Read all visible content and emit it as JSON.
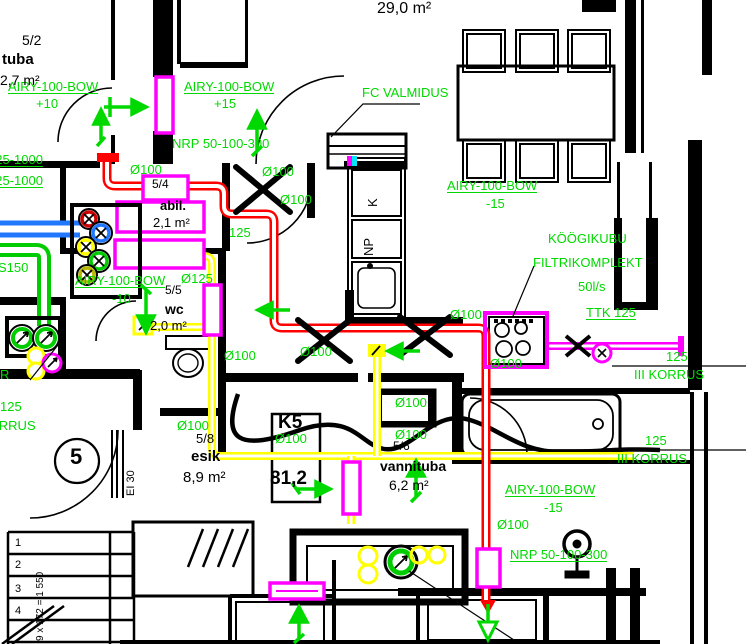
{
  "meta": {
    "drawing_type": "ventilation floor plan",
    "floor_reference": "III KORRUS",
    "apartment_code": "K5",
    "apartment_area": "81,2"
  },
  "colors": {
    "duct_exhaust_red": "#ff0000",
    "duct_yellow": "#ffff00",
    "silencer_magenta": "#ff00ff",
    "duct_supply_green": "#00cc00",
    "duct_blue": "#2277ff",
    "annotation_green": "#00d900",
    "line_black": "#000000",
    "background": "#ffffff"
  },
  "annotations": [
    {
      "t": "AIRY-100-BOW",
      "x": 8,
      "y": 80,
      "c": "g",
      "u": 1
    },
    {
      "t": "+10",
      "x": 36,
      "y": 97,
      "c": "g"
    },
    {
      "t": "AIRY-100-BOW",
      "x": 184,
      "y": 80,
      "c": "g",
      "u": 1
    },
    {
      "t": "+15",
      "x": 214,
      "y": 97,
      "c": "g"
    },
    {
      "t": "FC VALMIDUS",
      "x": 362,
      "y": 86,
      "c": "g"
    },
    {
      "t": "NRP 50-100-300",
      "x": 172,
      "y": 137,
      "c": "g"
    },
    {
      "t": "AIRY-100-BOW",
      "x": 447,
      "y": 179,
      "c": "g",
      "u": 1
    },
    {
      "t": "-15",
      "x": 486,
      "y": 197,
      "c": "g"
    },
    {
      "t": "KÖÖGIKUBU",
      "x": 548,
      "y": 232,
      "c": "g"
    },
    {
      "t": "FILTRIKOMPLEKT",
      "x": 533,
      "y": 256,
      "c": "g"
    },
    {
      "t": "50l/s",
      "x": 578,
      "y": 280,
      "c": "g"
    },
    {
      "t": "TTK 125",
      "x": 586,
      "y": 306,
      "c": "g",
      "u": 1
    },
    {
      "t": "125",
      "x": 666,
      "y": 350,
      "c": "g"
    },
    {
      "t": "III KORRUS",
      "x": 634,
      "y": 368,
      "c": "g"
    },
    {
      "t": "125",
      "x": 645,
      "y": 434,
      "c": "g"
    },
    {
      "t": "III KORRUS",
      "x": 617,
      "y": 452,
      "c": "g"
    },
    {
      "t": "AIRY-100-BOW",
      "x": 505,
      "y": 483,
      "c": "g",
      "u": 1
    },
    {
      "t": "-15",
      "x": 544,
      "y": 501,
      "c": "g"
    },
    {
      "t": "NRP 50-100-300",
      "x": 510,
      "y": 548,
      "c": "g",
      "u": 1
    },
    {
      "t": "AIRY-100-BOW",
      "x": 75,
      "y": 274,
      "c": "g",
      "u": 1
    },
    {
      "t": "-10",
      "x": 112,
      "y": 292,
      "c": "g"
    },
    {
      "t": "Ø125",
      "x": 181,
      "y": 272,
      "c": "g"
    },
    {
      "t": "Ø100",
      "x": 130,
      "y": 163,
      "c": "g"
    },
    {
      "t": "Ø100",
      "x": 262,
      "y": 165,
      "c": "g"
    },
    {
      "t": "Ø100",
      "x": 280,
      "y": 193,
      "c": "g"
    },
    {
      "t": "125",
      "x": 229,
      "y": 226,
      "c": "g"
    },
    {
      "t": "Ø100",
      "x": 224,
      "y": 349,
      "c": "g"
    },
    {
      "t": "Ø100",
      "x": 300,
      "y": 345,
      "c": "g"
    },
    {
      "t": "Ø100",
      "x": 450,
      "y": 308,
      "c": "g"
    },
    {
      "t": "Ø100",
      "x": 490,
      "y": 357,
      "c": "g"
    },
    {
      "t": "Ø100",
      "x": 395,
      "y": 396,
      "c": "g"
    },
    {
      "t": "Ø100",
      "x": 395,
      "y": 428,
      "c": "g"
    },
    {
      "t": "Ø100",
      "x": 177,
      "y": 419,
      "c": "g"
    },
    {
      "t": "Ø100",
      "x": 275,
      "y": 432,
      "c": "g"
    },
    {
      "t": "Ø100",
      "x": 497,
      "y": 518,
      "c": "g"
    },
    {
      "t": "125-1000",
      "x": -12,
      "y": 153,
      "c": "g",
      "u": 1
    },
    {
      "t": "125-1000",
      "x": -12,
      "y": 174,
      "c": "g",
      "u": 1
    },
    {
      "t": "S150",
      "x": -2,
      "y": 261,
      "c": "g"
    },
    {
      "t": "R",
      "x": 0,
      "y": 368,
      "c": "g"
    },
    {
      "t": "125",
      "x": 0,
      "y": 400,
      "c": "g"
    },
    {
      "t": "KORRUS",
      "x": -20,
      "y": 419,
      "c": "g"
    },
    {
      "t": "29,0 m²",
      "x": 377,
      "y": 1,
      "c": "b",
      "s": 16
    },
    {
      "t": "5/2",
      "x": 22,
      "y": 33,
      "c": "b",
      "s": 14
    },
    {
      "t": "tuba",
      "x": 2,
      "y": 52,
      "c": "b",
      "s": 15,
      "b": 1
    },
    {
      "t": "2,7 m²",
      "x": 0,
      "y": 73,
      "c": "b",
      "s": 14
    },
    {
      "t": "5/4",
      "x": 152,
      "y": 178,
      "c": "b",
      "s": 12
    },
    {
      "t": "abil.",
      "x": 160,
      "y": 199,
      "c": "b",
      "s": 13,
      "b": 1
    },
    {
      "t": "2,1 m²",
      "x": 153,
      "y": 216,
      "c": "b",
      "s": 13
    },
    {
      "t": "5/5",
      "x": 165,
      "y": 284,
      "c": "b",
      "s": 12
    },
    {
      "t": "wc",
      "x": 165,
      "y": 302,
      "c": "b",
      "s": 14,
      "b": 1
    },
    {
      "t": "2,0 m²",
      "x": 150,
      "y": 319,
      "c": "b",
      "s": 13
    },
    {
      "t": "5/8",
      "x": 196,
      "y": 432,
      "c": "b",
      "s": 13
    },
    {
      "t": "esik",
      "x": 191,
      "y": 449,
      "c": "b",
      "s": 15,
      "b": 1
    },
    {
      "t": "8,9 m²",
      "x": 183,
      "y": 470,
      "c": "b",
      "s": 15
    },
    {
      "t": "5/6",
      "x": 393,
      "y": 440,
      "c": "b",
      "s": 12
    },
    {
      "t": "vannituba",
      "x": 380,
      "y": 459,
      "c": "b",
      "s": 14,
      "b": 1
    },
    {
      "t": "6,2 m²",
      "x": 389,
      "y": 478,
      "c": "b",
      "s": 14
    },
    {
      "t": "K5",
      "x": 278,
      "y": 413,
      "c": "b",
      "s": 19,
      "b": 1
    },
    {
      "t": "81,2",
      "x": 270,
      "y": 469,
      "c": "b",
      "s": 19,
      "b": 1
    },
    {
      "t": "K",
      "x": 366,
      "y": 207,
      "c": "b",
      "s": 13,
      "rot": -90
    },
    {
      "t": "NP",
      "x": 362,
      "y": 256,
      "c": "b",
      "s": 13,
      "rot": -90
    },
    {
      "t": "5",
      "x": 70,
      "y": 446,
      "c": "b",
      "s": 22,
      "b": 1
    },
    {
      "t": "EI 30",
      "x": 126,
      "y": 496,
      "c": "b",
      "s": 11,
      "rot": -90
    },
    {
      "t": "1",
      "x": 15,
      "y": 538,
      "c": "b",
      "s": 11
    },
    {
      "t": "2",
      "x": 15,
      "y": 560,
      "c": "b",
      "s": 11
    },
    {
      "t": "3",
      "x": 15,
      "y": 584,
      "c": "b",
      "s": 11
    },
    {
      "t": "4",
      "x": 15,
      "y": 606,
      "c": "b",
      "s": 11
    },
    {
      "t": "9 x 172 = 1 550",
      "x": 36,
      "y": 641,
      "c": "b",
      "s": 10,
      "rot": -90
    }
  ]
}
